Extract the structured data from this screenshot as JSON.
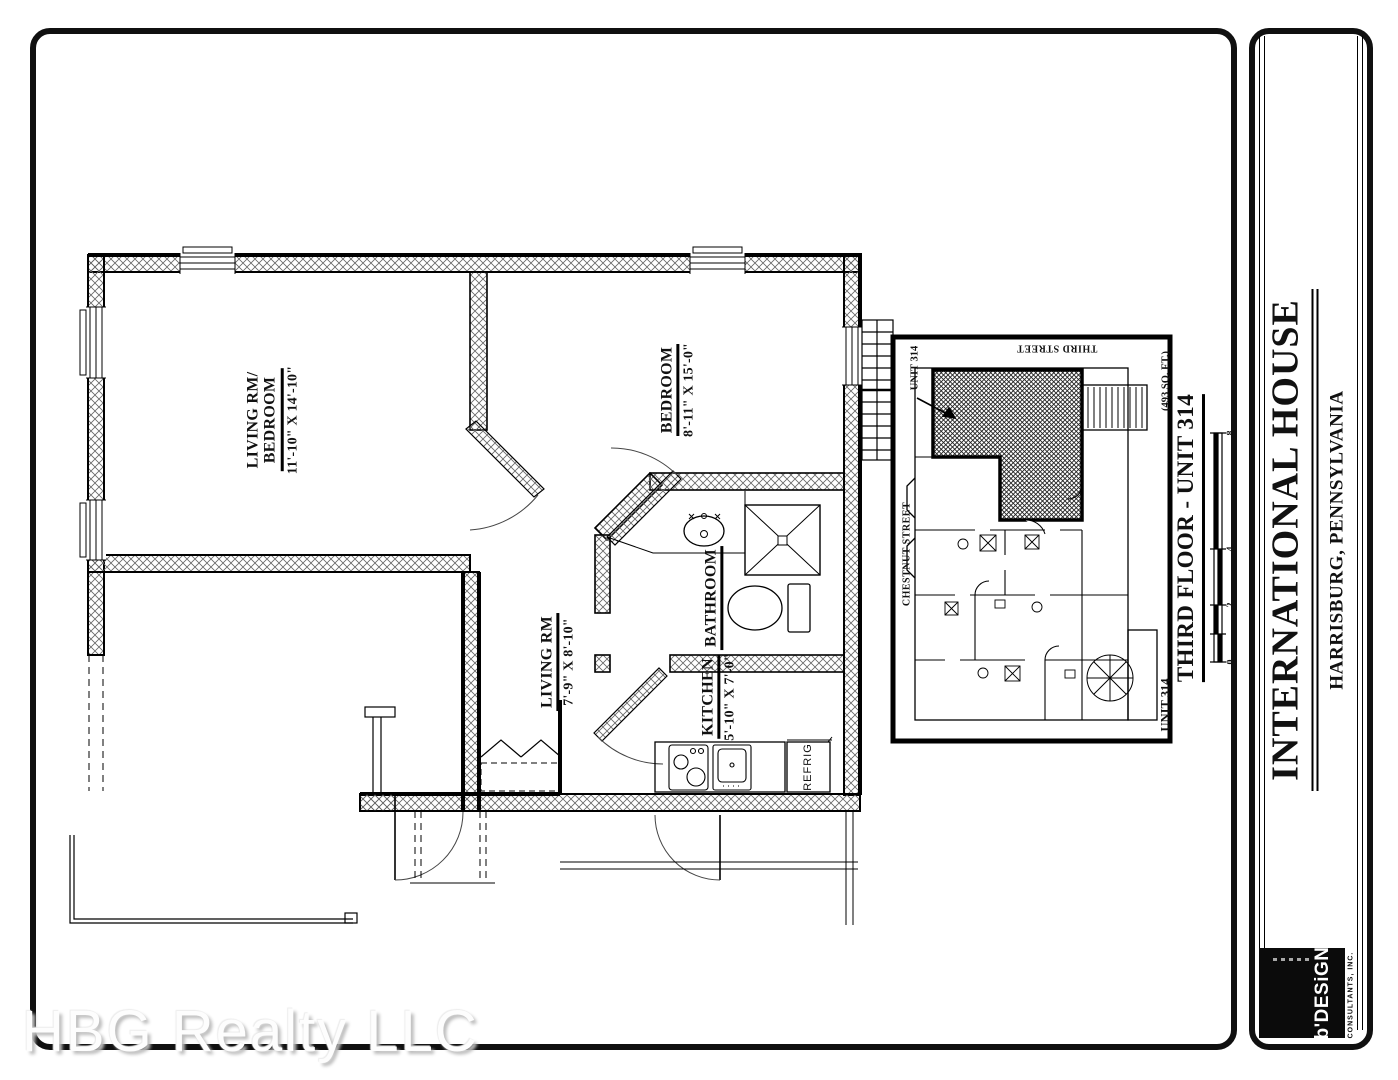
{
  "title_block": {
    "project": "INTERNATIONAL HOUSE",
    "location": "HARRISBURG, PENNSYLVANIA",
    "logo_brand": "b'DESiGN",
    "logo_sub": "CONSULTANTS, INC."
  },
  "drawing": {
    "title": "THIRD FLOOR - UNIT 314",
    "area": "(493 SQ. FT.)",
    "scale_marks": [
      "8",
      "4",
      "2",
      "0"
    ]
  },
  "rooms": {
    "living_bedroom": {
      "name1": "LIVING RM/",
      "name2": "BEDROOM",
      "dim": "11'-10\" X 14'-10\""
    },
    "bedroom": {
      "name": "BEDROOM",
      "dim": "8'-11\" X 15'-0\""
    },
    "living": {
      "name": "LIVING RM",
      "dim": "7'-9\" X 8'-10\""
    },
    "bathroom": {
      "name": "BATHROOM"
    },
    "kitchen": {
      "name": "KITCHEN",
      "dim": "5'-10\" X 7'-0\""
    },
    "refrigerator": "REFRIG"
  },
  "key_plan": {
    "unit_callout": "UNIT 314",
    "unit_label": "UNIT 314",
    "street_top": "THIRD STREET",
    "street_left": "CHESTNUT STREET"
  },
  "watermark": "HBG Realty LLC"
}
